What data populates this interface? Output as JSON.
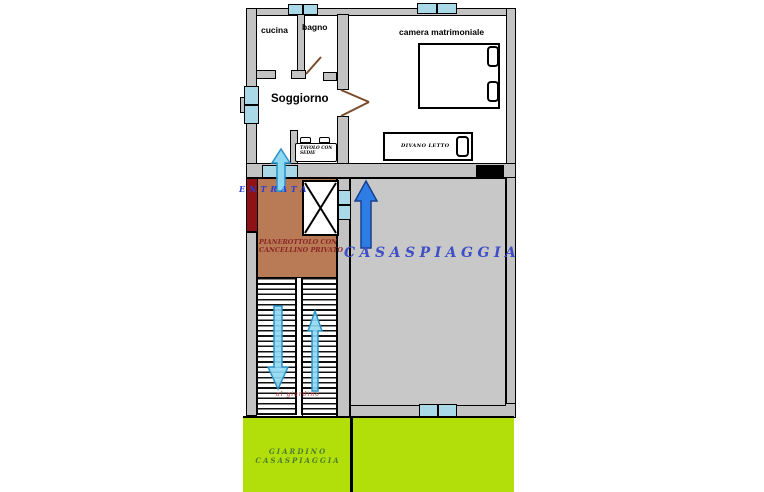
{
  "plan": {
    "rooms": {
      "cucina": "cucina",
      "bagno": "bagno",
      "camera_matrimoniale": "camera matrimoniale",
      "soggiorno": "Soggiorno"
    },
    "furniture": {
      "tavolo_line1": "TAVOLO CON",
      "tavolo_line2": "SEDIE",
      "divano_letto": "DIVANO LETTO"
    },
    "entrance": {
      "label": "ENTRATA"
    },
    "landing": {
      "line1": "PIANEROTTOLO CON",
      "line2": "CANCELLINO PRIVATO"
    },
    "terrace": {
      "label": "CASASPIAGGIA"
    },
    "stairs": {
      "note": "al giardino",
      "left_arrow_direction": "down",
      "right_arrow_direction": "up"
    },
    "garden": {
      "line1": "GIARDINO",
      "line2": "CASASPIAGGIA"
    },
    "arrows": {
      "entrance_arrow": "up",
      "terrace_arrow": "up"
    },
    "colors": {
      "wall": "#c3c3c3",
      "window": "#a9d9e6",
      "landing_floor": "#b87b56",
      "entrance_wall": "#8e1216",
      "terrace_floor": "#c8c8c8",
      "garden": "#b2df0a",
      "stair_arrow": "#8fd8f2",
      "terrace_arrow": "#2e7de4",
      "label_blue": "#3d4ec6",
      "landing_text": "#8b2626",
      "garden_text": "#4d7e2f",
      "stairs_note_text": "#c23434"
    }
  }
}
